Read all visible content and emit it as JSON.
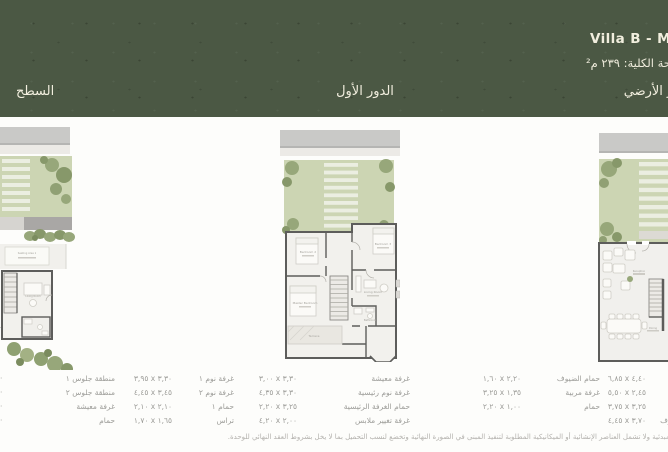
{
  "header": {
    "title": "Villa B - M",
    "total_area_label": "المساحة الكلية: ٢٣٩ م²",
    "floor_labels": {
      "roof": "السطح",
      "first": "الدور الأول",
      "ground": "الدور الأرضي"
    }
  },
  "plans": {
    "roof": {
      "labels": {
        "seating": "Seating Area 1",
        "living": "Living Room",
        "side_note": "منطقة جلوس"
      }
    },
    "first": {
      "labels": {
        "bedroom2": "Bedroom 2",
        "bedroom3": "Bedroom 3",
        "master": "Master Bedroom",
        "living": "Living Room",
        "terrace": "Terrace",
        "bathroom": "Bathroom"
      }
    },
    "ground": {
      "labels": {
        "reception": "Reception",
        "dining": "Dining"
      }
    }
  },
  "legend": {
    "groups": [
      {
        "name": "roof-plan-rooms",
        "rows": [
          {
            "label": "منطقة جلوس ١",
            "dim": ""
          },
          {
            "label": "منطقة جلوس ٢",
            "dim": ""
          },
          {
            "label": "غرفة معيشة",
            "dim": ""
          },
          {
            "label": "حمام",
            "dim": ""
          }
        ]
      },
      {
        "name": "first-floor-rooms-a",
        "rows": [
          {
            "label": "غرفة نوم ١",
            "dim": "٣,٩٥ x ٣,٣٠"
          },
          {
            "label": "غرفة نوم ٢",
            "dim": "٤,٤٥ x ٣,٤٥"
          },
          {
            "label": "حمام ١",
            "dim": "٢,١٠ x ٢,١٠"
          },
          {
            "label": "تراس",
            "dim": "١,٧٠ x ١,٦٥"
          }
        ]
      },
      {
        "name": "first-floor-rooms-b",
        "rows": [
          {
            "label": "غرفة معيشة",
            "dim": "٣,٠٠ x ٣,٣٠"
          },
          {
            "label": "غرفة نوم رئيسية",
            "dim": "٤,٣٥ x ٣,٣٠"
          },
          {
            "label": "حمام الغرفة الرئيسية",
            "dim": "٢,٢٠ x ٣,٢٥"
          },
          {
            "label": "غرفة تغيير ملابس",
            "dim": "٤,٢٠ x ٢,٠٠"
          }
        ]
      },
      {
        "name": "ground-floor-rooms-a",
        "rows": [
          {
            "label": "حمام الضيوف",
            "dim": "١,٦٠ x ٢,٢٠"
          },
          {
            "label": "غرفة مربية",
            "dim": "٣,٢٥ x ١,٣٥"
          },
          {
            "label": "حمام",
            "dim": "٢,٢٠ x ١,٠٠"
          },
          {
            "label": "",
            "dim": ""
          }
        ]
      },
      {
        "name": "ground-floor-rooms-b",
        "rows": [
          {
            "label": "",
            "dim": "٦,٨٥ x ٤,٤٠"
          },
          {
            "label": "",
            "dim": "٥,٥٠ x ٢,٤٥"
          },
          {
            "label": "",
            "dim": "٣,٧٥ x ٣,٢٥"
          },
          {
            "label": "غرفة الضيوف",
            "dim": "٤,٤٥ x ٣,٧٠"
          }
        ]
      }
    ],
    "edge_fragments": [
      "·",
      "·",
      "·",
      "·"
    ],
    "disclaimer": "المساحات المبينة أعلاه مبدئية ولا تشمل العناصر الإنشائية أو الميكانيكية المطلوبة لتنفيذ المبنى في الصورة النهائية وتخضع لنسب التحميل بما لا يخل بشروط العقد النهائي للوحدة."
  },
  "colors": {
    "header_band": "#4b5844",
    "header_text": "#f1eede",
    "garden_green": "#ccd5b3",
    "tree_olive": "#97a77a",
    "roof_strip_gray": "#c9c9c7",
    "wall_gray": "#5d5d5b",
    "floor_fill": "#f2f1ed",
    "legend_text": "#9c9c98"
  }
}
